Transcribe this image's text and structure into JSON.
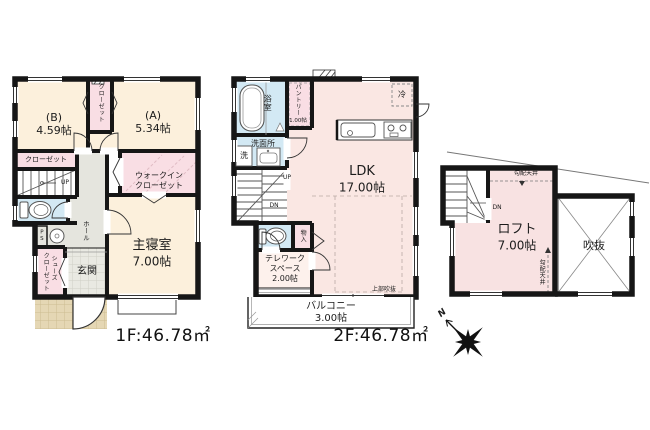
{
  "colors": {
    "wall": "#161616",
    "room_cream": "#fcf0dc",
    "closet_pink": "#f9dee4",
    "ldk_pink": "#fae7e3",
    "wet_blue": "#d3e9f4",
    "hall_gray": "#e5e5de",
    "entrance_tile": "#e9e9e2",
    "porch_tan": "#e5d7b4"
  },
  "compass": {
    "north": "N"
  },
  "floor1": {
    "area": "1F:46.78㎡",
    "room_b_name": "(B)",
    "room_b_size": "4.59帖",
    "room_a_name": "(A)",
    "room_a_size": "5.34帖",
    "closet_vertical": "クローゼット",
    "closet": "クローゼット",
    "stairs_up": "UP",
    "walkin_1": "ウォークイン",
    "walkin_2": "クローゼット",
    "hall": "ホール",
    "ps": "PS",
    "shoes_1": "シューズ",
    "shoes_2": "クローゼット",
    "entrance": "玄関",
    "master_1": "主寝室",
    "master_2": "7.00帖"
  },
  "floor2": {
    "area": "2F:46.78㎡",
    "bath": "浴室",
    "pantry": "パントリー",
    "pantry_size": "1.00帖",
    "fridge": "冷",
    "washroom": "洗面所",
    "washer": "洗",
    "stairs_up": "UP",
    "stairs_dn": "DN",
    "storage": "物入",
    "telework_1": "テレワーク",
    "telework_2": "スペース",
    "telework_3": "2.00帖",
    "ldk_1": "LDK",
    "ldk_2": "17.00帖",
    "open_above": "上部吹抜",
    "balcony_1": "バルコニー",
    "balcony_2": "3.00帖"
  },
  "loft": {
    "stairs_dn": "DN",
    "name_1": "ロフト",
    "name_2": "7.00帖",
    "void": "吹抜",
    "sloped_ceiling_top": "勾配天井",
    "sloped_ceiling_side": "勾配天井"
  }
}
